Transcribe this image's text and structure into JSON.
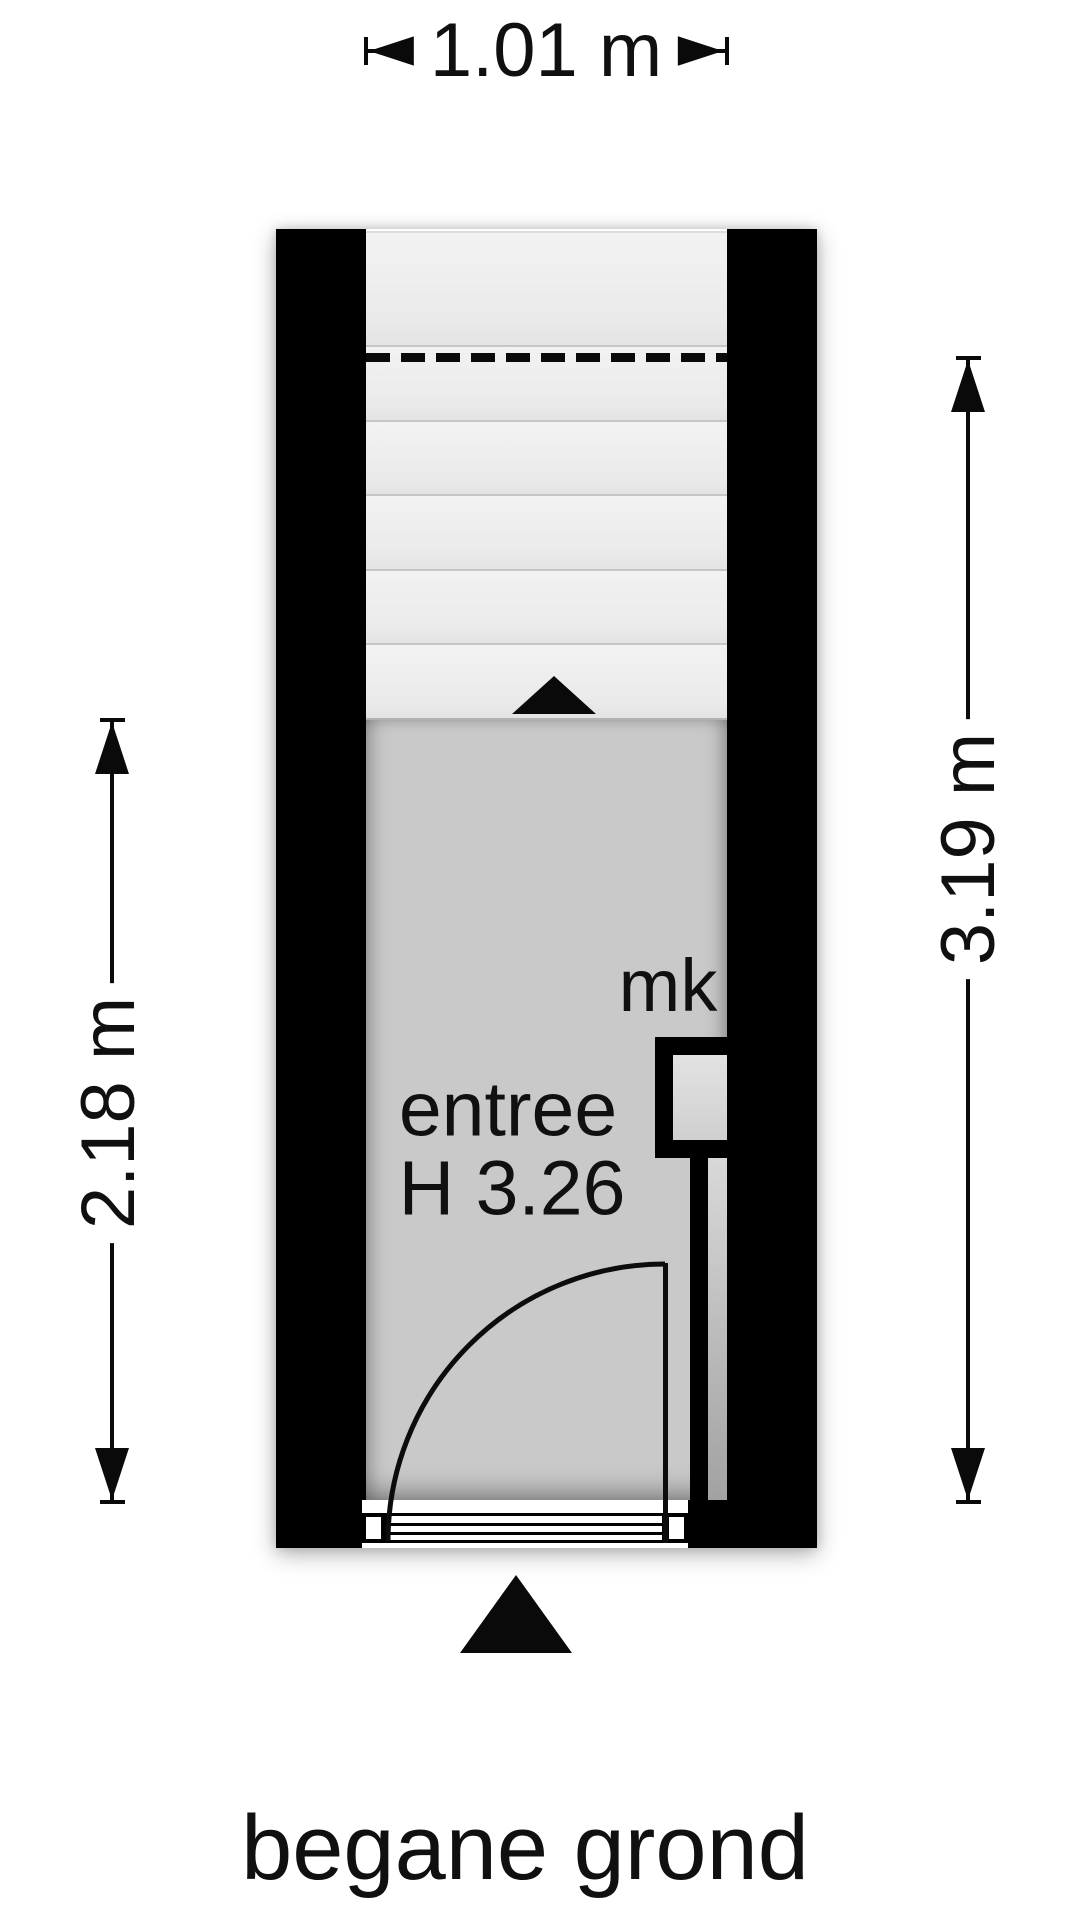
{
  "floor_title": "begane grond",
  "plan": {
    "room_label": "entree",
    "room_height_label": "H 3.26",
    "meter_cupboard_label": "mk",
    "dimensions": {
      "width_top": "1.01 m",
      "left_height": "2.18 m",
      "right_height": "3.19 m"
    },
    "stairs": {
      "step_count": 6,
      "direction": "up",
      "has_cut_line": true
    },
    "colors": {
      "wall": "#000000",
      "room_fill": "#c9c9c9",
      "stairs_fill": "#efefef",
      "mk_inner_fill": "#dcdcdc",
      "background": "#ffffff"
    }
  }
}
